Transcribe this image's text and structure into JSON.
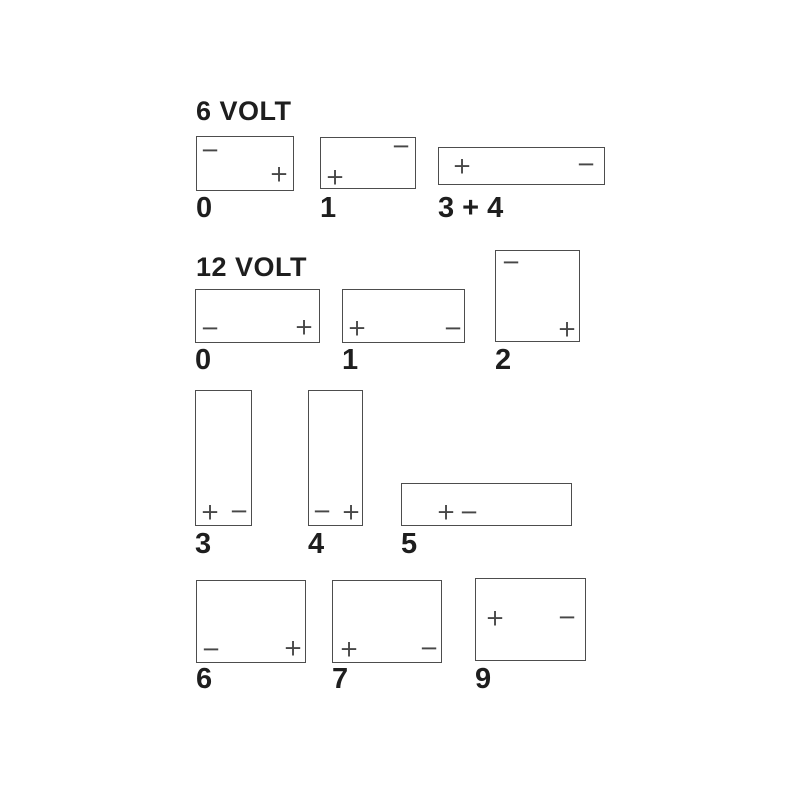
{
  "diagram_title": "Battery terminal layout diagram",
  "background": "#ffffff",
  "colors": {
    "outline": "#4d4d4d",
    "text": "#1e1e1e",
    "terminal": "#474747"
  },
  "symbols": {
    "plus": "+",
    "minus": "−"
  },
  "sections": [
    {
      "id": "6-volt",
      "title": "6 VOLT",
      "batteries": [
        {
          "label": "0",
          "x": 196,
          "y": 136,
          "w": 98,
          "h": 55,
          "label_y": 193,
          "terminals": [
            {
              "sign": "minus",
              "tx": 13,
              "ty": 14
            },
            {
              "sign": "plus",
              "tx": 82,
              "ty": 38
            }
          ]
        },
        {
          "label": "1",
          "x": 320,
          "y": 137,
          "w": 96,
          "h": 52,
          "label_y": 193,
          "terminals": [
            {
              "sign": "plus",
              "tx": 14,
              "ty": 40
            },
            {
              "sign": "minus",
              "tx": 80,
              "ty": 9
            }
          ]
        },
        {
          "label": "3 + 4",
          "x": 438,
          "y": 147,
          "w": 167,
          "h": 38,
          "label_y": 193,
          "terminals": [
            {
              "sign": "plus",
              "tx": 23,
              "ty": 19
            },
            {
              "sign": "minus",
              "tx": 147,
              "ty": 17
            }
          ]
        }
      ]
    },
    {
      "id": "12-volt",
      "title": "12 VOLT",
      "batteries": [
        {
          "label": "0",
          "x": 195,
          "y": 289,
          "w": 125,
          "h": 54,
          "label_y": 345,
          "terminals": [
            {
              "sign": "minus",
              "tx": 14,
              "ty": 39
            },
            {
              "sign": "plus",
              "tx": 108,
              "ty": 38
            }
          ]
        },
        {
          "label": "1",
          "x": 342,
          "y": 289,
          "w": 123,
          "h": 54,
          "label_y": 345,
          "terminals": [
            {
              "sign": "plus",
              "tx": 14,
              "ty": 39
            },
            {
              "sign": "minus",
              "tx": 110,
              "ty": 39
            }
          ]
        },
        {
          "label": "2",
          "x": 495,
          "y": 250,
          "w": 85,
          "h": 92,
          "label_y": 345,
          "terminals": [
            {
              "sign": "minus",
              "tx": 15,
              "ty": 12
            },
            {
              "sign": "plus",
              "tx": 71,
              "ty": 79
            }
          ]
        },
        {
          "label": "3",
          "x": 195,
          "y": 390,
          "w": 57,
          "h": 136,
          "label_y": 529,
          "terminals": [
            {
              "sign": "plus",
              "tx": 14,
              "ty": 122
            },
            {
              "sign": "minus",
              "tx": 43,
              "ty": 121
            }
          ]
        },
        {
          "label": "4",
          "x": 308,
          "y": 390,
          "w": 55,
          "h": 136,
          "label_y": 529,
          "terminals": [
            {
              "sign": "minus",
              "tx": 13,
              "ty": 121
            },
            {
              "sign": "plus",
              "tx": 42,
              "ty": 122
            }
          ]
        },
        {
          "label": "5",
          "x": 401,
          "y": 483,
          "w": 171,
          "h": 43,
          "label_y": 529,
          "terminals": [
            {
              "sign": "plus",
              "tx": 44,
              "ty": 29
            },
            {
              "sign": "minus",
              "tx": 67,
              "ty": 29
            }
          ]
        },
        {
          "label": "6",
          "x": 196,
          "y": 580,
          "w": 110,
          "h": 83,
          "label_y": 664,
          "terminals": [
            {
              "sign": "minus",
              "tx": 14,
              "ty": 69
            },
            {
              "sign": "plus",
              "tx": 96,
              "ty": 68
            }
          ]
        },
        {
          "label": "7",
          "x": 332,
          "y": 580,
          "w": 110,
          "h": 83,
          "label_y": 664,
          "terminals": [
            {
              "sign": "plus",
              "tx": 16,
              "ty": 69
            },
            {
              "sign": "minus",
              "tx": 96,
              "ty": 68
            }
          ]
        },
        {
          "label": "9",
          "x": 475,
          "y": 578,
          "w": 111,
          "h": 83,
          "label_y": 664,
          "terminals": [
            {
              "sign": "plus",
              "tx": 19,
              "ty": 40
            },
            {
              "sign": "minus",
              "tx": 91,
              "ty": 39
            }
          ]
        }
      ]
    }
  ]
}
